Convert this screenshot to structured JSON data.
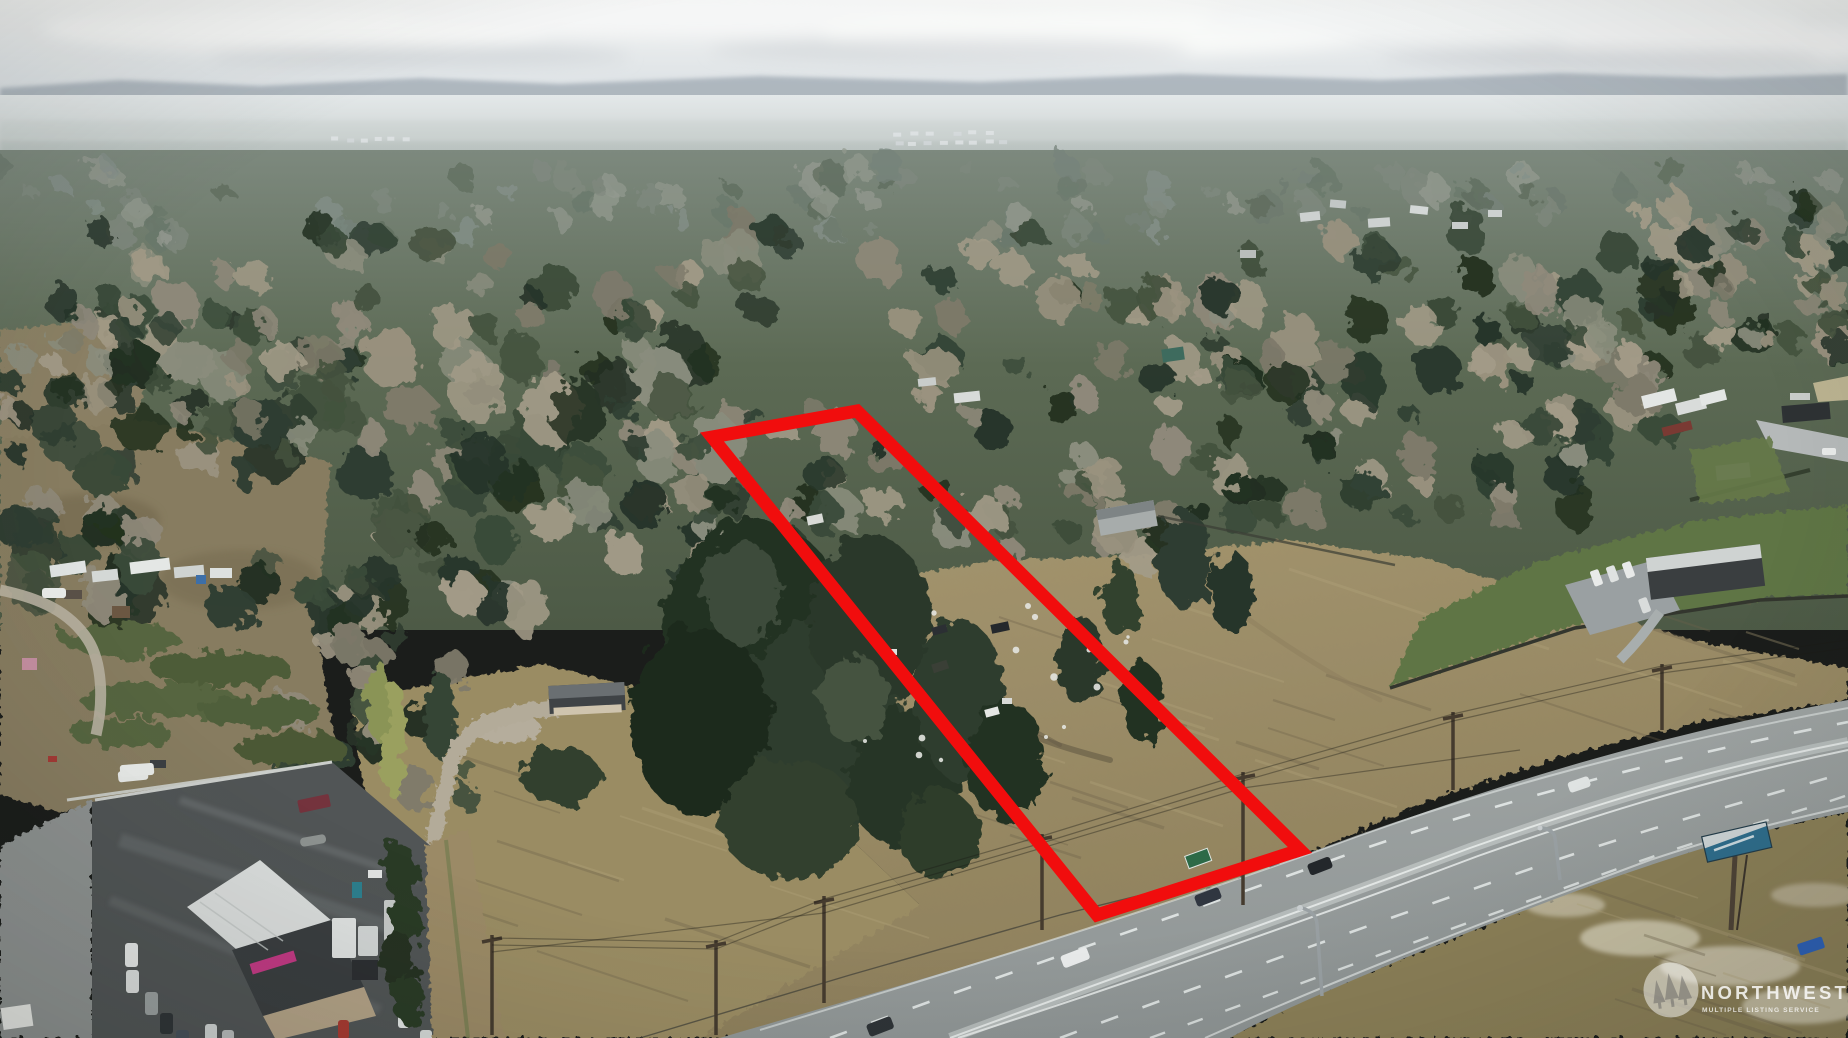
{
  "watermark": {
    "brand": "NORTHWEST",
    "subtitle": "MULTIPLE LISTING SERVICE",
    "logo_icon": "evergreen-trees-badge"
  },
  "boundary": {
    "label": "outlined-parcel",
    "color": "#f10d0d",
    "points": "712,437 857,411 1300,850 1097,915",
    "stroke_width": "13"
  },
  "colors": {
    "sky": "#e9edef",
    "ridge": "#9fa9b2",
    "conifer": "#2e3d31",
    "bare_trees": "#938c7a",
    "field": "#9c8c66",
    "highway": "#9aa09f",
    "parking_lot": "#515556",
    "lawn": "#5f7444",
    "dirt_road": "#9b8a66"
  }
}
